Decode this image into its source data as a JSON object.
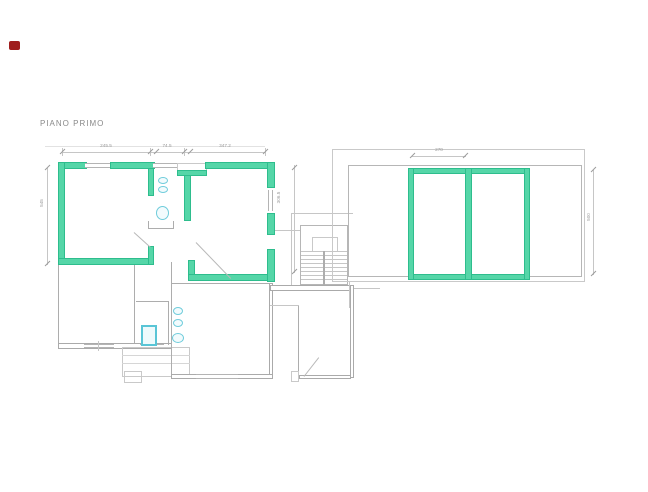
{
  "title": {
    "text": "PIANO PRIMO"
  },
  "colors": {
    "background": "#ffffff",
    "highlight_green": "#3ed0a0",
    "wall_gray": "#adadad",
    "fixture_cyan": "#6fccdb",
    "dimension_gray": "#c6c6c6",
    "label_gray": "#9a9a9a",
    "logo_red": "#9f1d1d"
  },
  "dimensions": {
    "top_labels": [
      "245.5",
      "74.5",
      "347.2"
    ],
    "left_label": "545",
    "inner_right_label": "306.5",
    "wing_top_label": "270",
    "wing_right_label": "500"
  }
}
